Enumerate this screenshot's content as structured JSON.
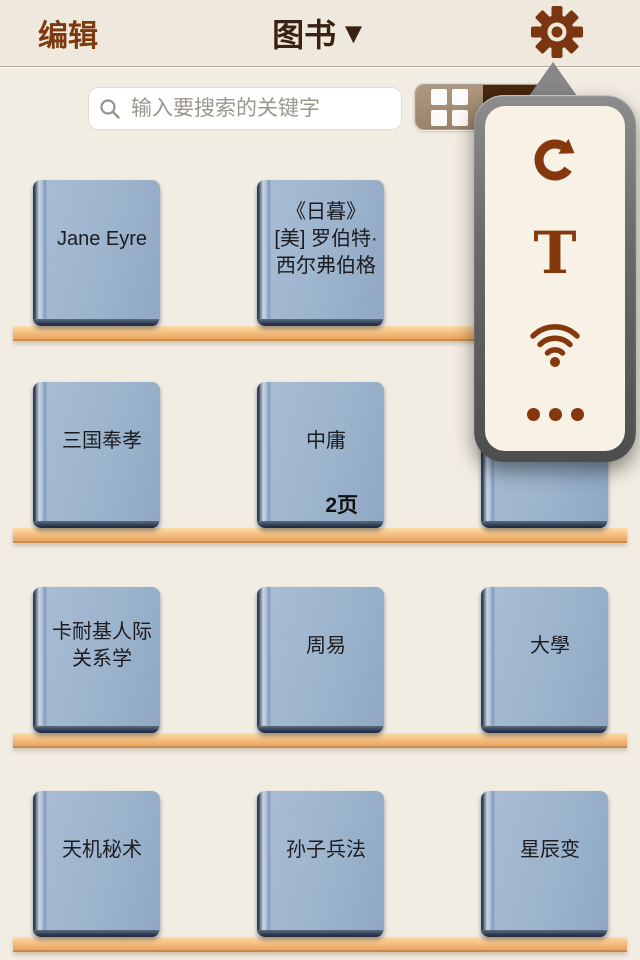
{
  "header": {
    "edit_label": "编辑",
    "title": "图书",
    "title_caret": "▼"
  },
  "search": {
    "placeholder": "输入要搜索的关键字",
    "value": ""
  },
  "view_toggle": {
    "grid_mode": "grid-view",
    "list_mode": "list-view"
  },
  "popover": {
    "text_size_label": "T",
    "items": [
      "refresh",
      "text-size",
      "wifi-transfer",
      "more"
    ]
  },
  "shelves": [
    {
      "books": [
        {
          "title": "Jane Eyre"
        },
        {
          "title": "《日暮》[美] 罗伯特·西尔弗伯格"
        }
      ]
    },
    {
      "books": [
        {
          "title": "三国奉孝"
        },
        {
          "title": "中庸",
          "badge": "2页"
        },
        {
          "title": ""
        }
      ]
    },
    {
      "books": [
        {
          "title": "卡耐基人际关系学"
        },
        {
          "title": "周易"
        },
        {
          "title": "大學"
        }
      ]
    },
    {
      "books": [
        {
          "title": "天机秘术"
        },
        {
          "title": "孙子兵法"
        },
        {
          "title": "星辰变"
        }
      ]
    }
  ],
  "colors": {
    "accent_brown": "#7d3a11",
    "popover_icon_brown": "#84380c",
    "title_dark": "#3a2113",
    "book_cover": "#9db4cd",
    "shelf_wood": "#f3bc7d",
    "background": "#f2ede3",
    "header_background": "#efe8dc"
  }
}
